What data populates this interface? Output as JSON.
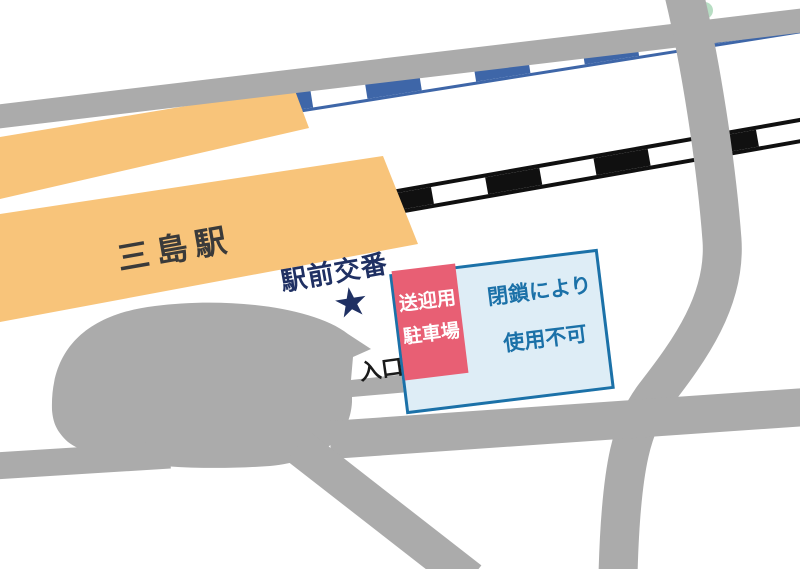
{
  "labels": {
    "station": "三島駅",
    "police_box": "駅前交番",
    "police_box_marker": "★",
    "entrance": "入口",
    "parking_line1": "送迎用",
    "parking_line2": "駐車場",
    "closed_line1": "閉鎖により",
    "closed_line2": "使用不可"
  },
  "colors": {
    "building": "#F8C47A",
    "road": "#ABABAB",
    "jr-line": "#3E66A8",
    "local-line": "#101010",
    "parking-fill": "#E85F74",
    "closed-fill": "#DEEDF6",
    "closed-border": "#1B71A8",
    "closed-text": "#1B71A8",
    "marker-navy": "#1F3063",
    "station-text": "#3A3A3A",
    "entrance-text": "#1A1A1A",
    "signal-green": "#B7DDC3"
  }
}
